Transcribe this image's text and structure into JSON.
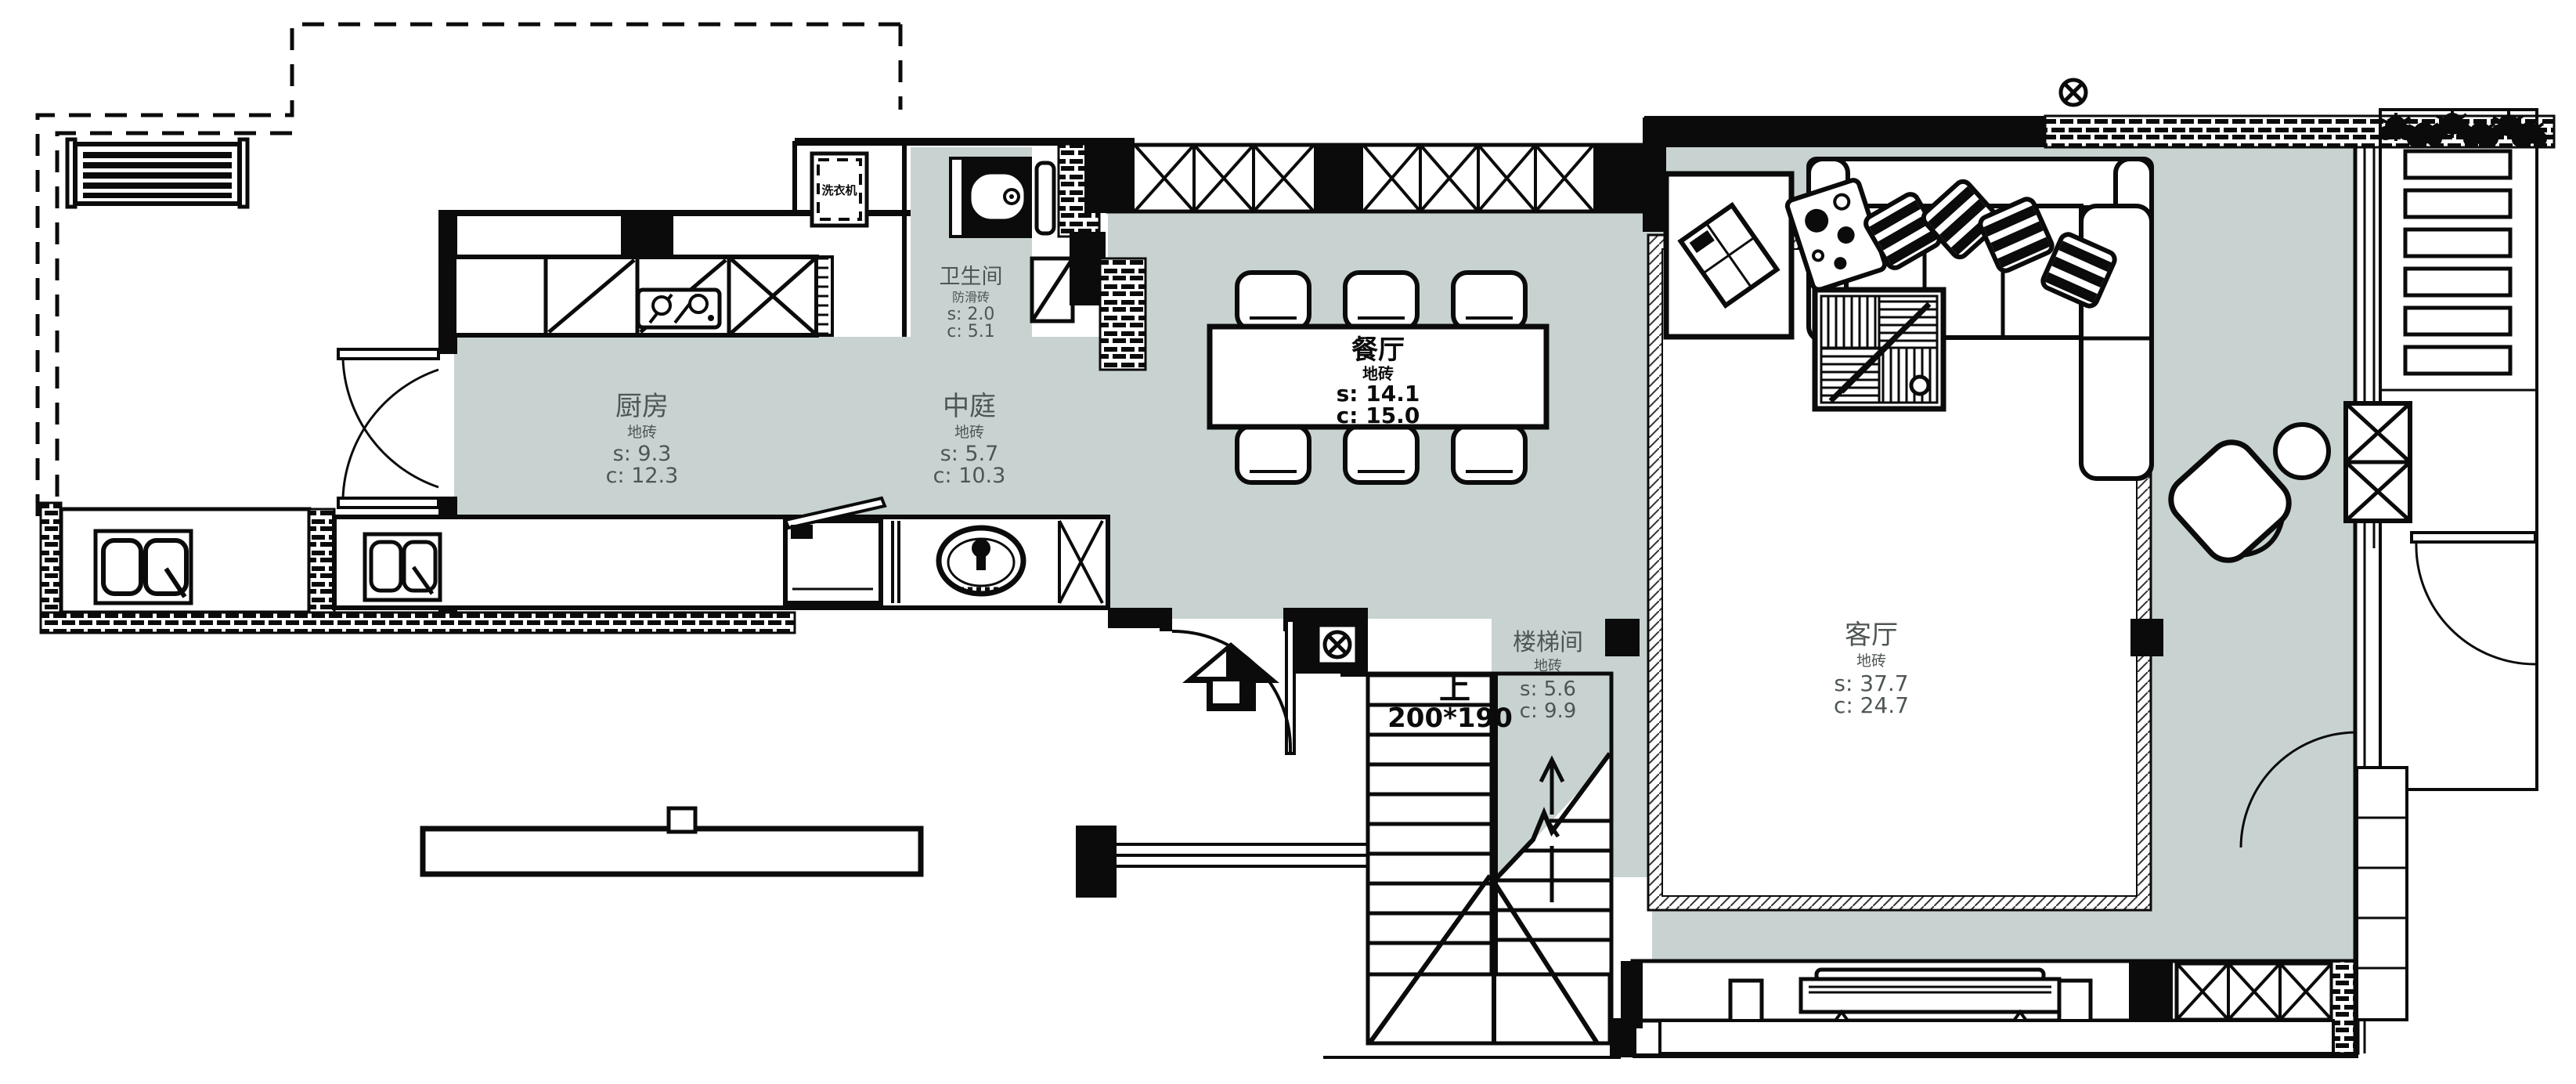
{
  "drawing": {
    "type": "residential-floor-plan",
    "floor_color": "#c8d3d1",
    "line_color": "#0b0b0b"
  },
  "rooms": [
    {
      "key": "bathroom",
      "name": "卫生间",
      "finish": "防滑砖",
      "area": "s: 2.0",
      "circulation": "c: 5.1"
    },
    {
      "key": "kitchen",
      "name": "厨房",
      "finish": "地砖",
      "area": "s: 9.3",
      "circulation": "c: 12.3"
    },
    {
      "key": "atrium",
      "name": "中庭",
      "finish": "地砖",
      "area": "s: 5.7",
      "circulation": "c: 10.3"
    },
    {
      "key": "dining",
      "name": "餐厅",
      "finish": "地砖",
      "area": "s: 14.1",
      "circulation": "c: 15.0"
    },
    {
      "key": "stairwell",
      "name": "楼梯间",
      "finish": "地砖",
      "area": "s: 5.6",
      "circulation": "c: 9.9"
    },
    {
      "key": "living",
      "name": "客厅",
      "finish": "地砖",
      "area": "s: 37.7",
      "circulation": "c: 24.7"
    }
  ],
  "stairs": {
    "direction_label": "上",
    "tread_size": "200*190"
  },
  "appliances": {
    "washing_machine_label": "洗衣机"
  }
}
